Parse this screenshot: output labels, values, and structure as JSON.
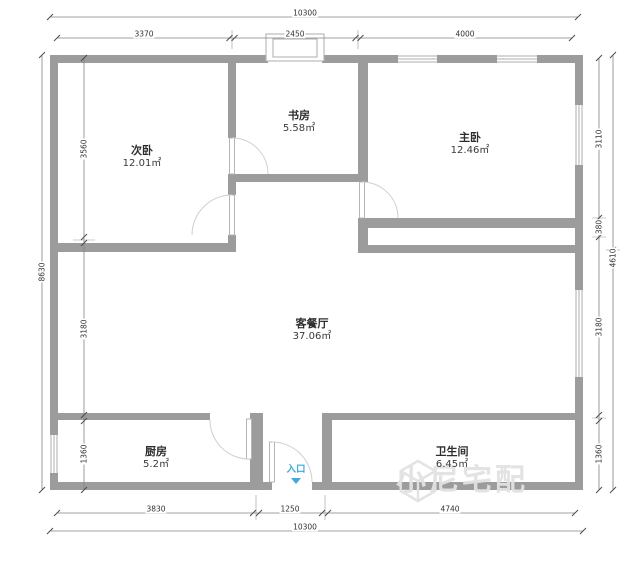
{
  "rooms": [
    {
      "name": "次卧",
      "area": "12.01㎡"
    },
    {
      "name": "书房",
      "area": "5.58㎡"
    },
    {
      "name": "主卧",
      "area": "12.46㎡"
    },
    {
      "name": "客餐厅",
      "area": "37.06㎡"
    },
    {
      "name": "厨房",
      "area": "5.2㎡"
    },
    {
      "name": "卫生间",
      "area": "6.45㎡"
    }
  ],
  "entrance": {
    "label": "入口"
  },
  "dimensions": {
    "top": {
      "total": "10300",
      "segments": [
        "3370",
        "2450",
        "4000"
      ]
    },
    "bottom": {
      "total": "10300",
      "segments": [
        "3830",
        "1250",
        "4740"
      ]
    },
    "left": {
      "total": "8630",
      "segments": [
        "3560",
        "3180",
        "1360"
      ]
    },
    "right": {
      "outer": "4610",
      "segments": [
        "3110",
        "380",
        "3180",
        "1360"
      ]
    }
  },
  "watermark": {
    "text": "小尼宅配"
  },
  "colors": {
    "wall": "#9c9c9c",
    "dimension_line": "#828282",
    "door_arc": "#cfcfcf",
    "entrance_blue": "#3fa8dc",
    "watermark": "#e2e2e2"
  }
}
